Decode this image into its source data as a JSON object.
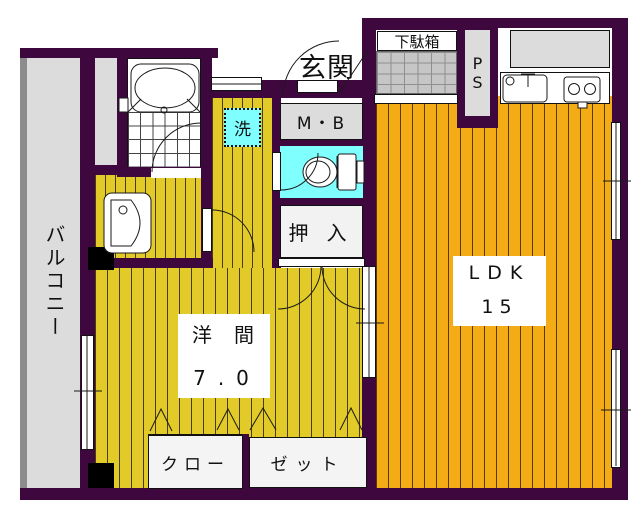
{
  "floorplan": {
    "outside_label": "玄関",
    "balcony_label": "バルコニー",
    "getabako_label": "下駄箱",
    "ps_label": "PS",
    "mb_label": "M・B",
    "washer_label": "洗",
    "oshiire_label": "押入",
    "ldk_name": "LDK",
    "ldk_size": "15",
    "western_name": "洋間",
    "western_size": "7.0",
    "closet_left_label": "クロー",
    "closet_right_label": "ゼット",
    "colors": {
      "wall": "#3E083E",
      "yellow_floor": "#E2CB28",
      "orange_floor": "#F3AC15",
      "wet_area_cyan": "#80FFFF",
      "gray_area": "#DCDCDC",
      "entrance_tile": "#C6C6C6",
      "closet_white": "#F4F4F4"
    }
  }
}
